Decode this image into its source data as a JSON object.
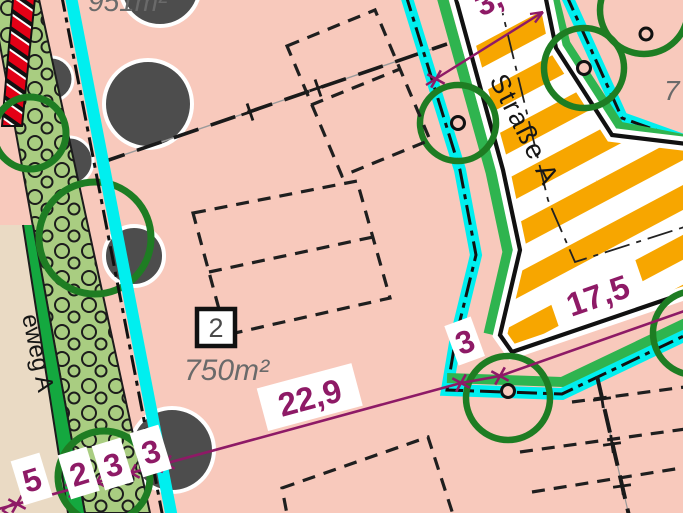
{
  "map": {
    "street_label": "Straße A",
    "path_label": "eweg A",
    "parcels": {
      "parcel_number": "2",
      "parcel_area": "750m²",
      "area_top_partial": "951m²",
      "area_right_partial": "7"
    },
    "dimensions": {
      "chain": [
        "5",
        "2",
        "3",
        "3",
        "22,9",
        "3",
        "17,5"
      ],
      "top_partial": "3,"
    },
    "colors": {
      "parcel_pink": "#F8C9BC",
      "street_orange": "#F7A600",
      "boundary_cyan": "#00EFEF",
      "dimension_magenta": "#8E1A66",
      "street_green_band": "#2FB44F",
      "hedge_green": "#A9CD81",
      "path_beige": "#EADAC4",
      "divider_green": "#14A83F",
      "hatch_red": "#E30016",
      "tree_green": "#1E7D23",
      "existing_tree_gray": "#4D4D4D"
    }
  }
}
